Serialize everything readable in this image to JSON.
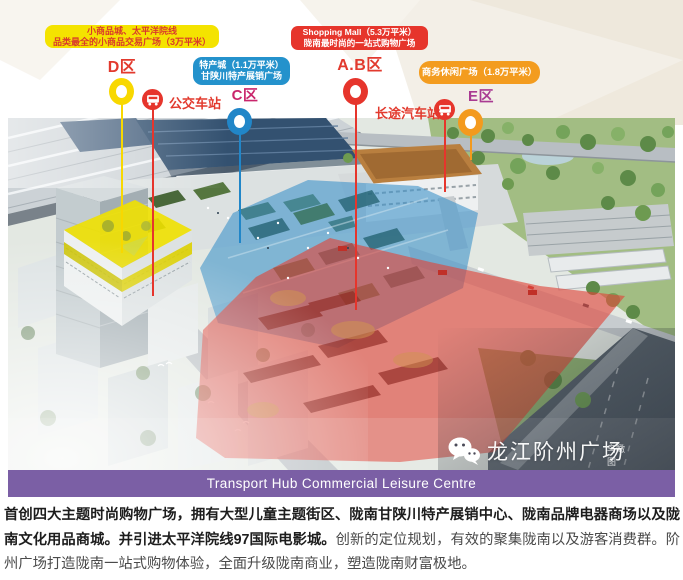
{
  "bubbles": {
    "d": {
      "line1": "小商品城、太平洋院线",
      "line2": "品类最全的小商品交易广场（3万平米）",
      "bg": "#f4e300",
      "fg": "#d93a2b"
    },
    "c": {
      "line1": "特产城（1.1万平米）",
      "line2": "甘陕川特产展销广场",
      "bg": "#2492cc",
      "fg": "#ffffff"
    },
    "ab": {
      "line1": "Shopping Mall（5.3万平米）",
      "line2": "陇南最时尚的一站式购物广场",
      "bg": "#e6352c",
      "fg": "#ffffff"
    },
    "e": {
      "line1": "商务休闲广场（1.8万平米）",
      "bg": "#f39c1f",
      "fg": "#ffffff"
    }
  },
  "zones": {
    "d": {
      "label": "D区",
      "label_color": "#e23a2e"
    },
    "c": {
      "label": "C区",
      "label_color": "#c9266c"
    },
    "ab": {
      "label": "A.B区",
      "label_color": "#e23a2e"
    },
    "e": {
      "label": "E区",
      "label_color": "#a93a92"
    }
  },
  "stations": {
    "bus": {
      "label": "公交车站"
    },
    "coach": {
      "label": "长途汽车站"
    },
    "label_color": "#e23a2e"
  },
  "colors": {
    "marker_yellow": "#f8d800",
    "marker_blue": "#2186c8",
    "marker_red": "#e6352c",
    "marker_orange": "#f39a1e",
    "overlay_yellow": "#efe100",
    "overlay_blue": "#3d92c9",
    "overlay_red": "#e14338",
    "banner_purple": "#7b5fa5"
  },
  "banner": {
    "title": "Transport Hub Commercial Leisure Centre"
  },
  "watermark": {
    "brand": "龙江阶州广场",
    "note": "鸟瞰图"
  },
  "description": {
    "bold": "首创四大主题时尚购物广场，拥有大型儿童主题街区、陇南甘陕川特产展销中心、陇南品牌电器商场以及陇南文化用品商城。并引进太平洋院线97国际电影城。",
    "regular": "创新的定位规划，有效的聚集陇南以及游客消费群。阶州广场打造陇南一站式购物体验，全面升级陇南商业，塑造陇南财富极地。"
  }
}
